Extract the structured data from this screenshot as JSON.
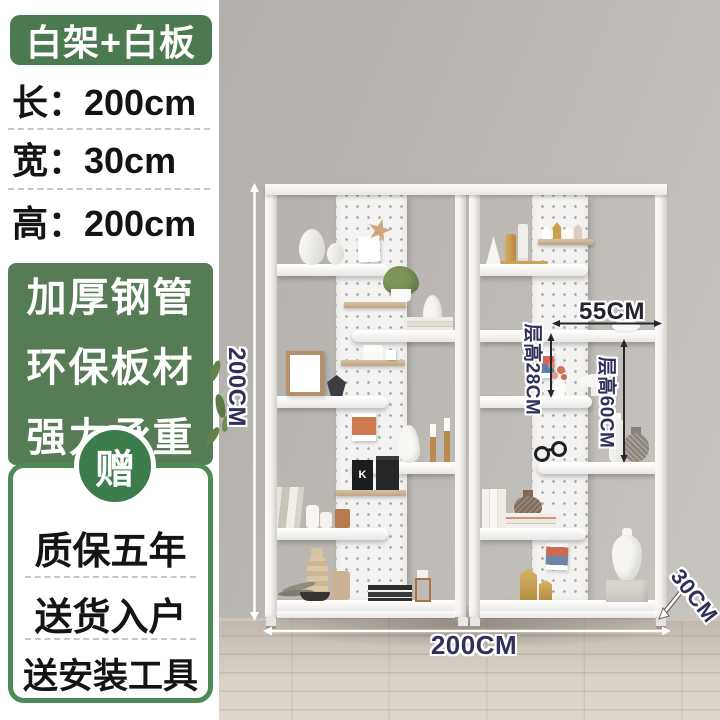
{
  "panel": {
    "badge_label": "白架+白板",
    "dim_rows": [
      "长：200cm",
      "宽：30cm",
      "高：200cm"
    ],
    "feature_lines": [
      "加厚钢管",
      "环保板材",
      "强力承重"
    ],
    "gift_char": "赠",
    "service_rows": [
      "质保五年",
      "送货入户",
      "送安装工具"
    ],
    "colors": {
      "badge_green": "#4c7a50",
      "feature_green": "#567c55",
      "circle_green": "#3c7c4b",
      "border_green": "#4d8a55"
    }
  },
  "scene": {
    "dimension_labels": {
      "height": "200CM",
      "width": "200CM",
      "shelf_width": "55CM",
      "tier_height_small": "层高28CM",
      "tier_height_large": "层高60CM",
      "depth": "30CM"
    },
    "colors": {
      "wall": "#b9b5b1",
      "floor": "#d8d1c5",
      "label_navy": "#30305a"
    }
  }
}
